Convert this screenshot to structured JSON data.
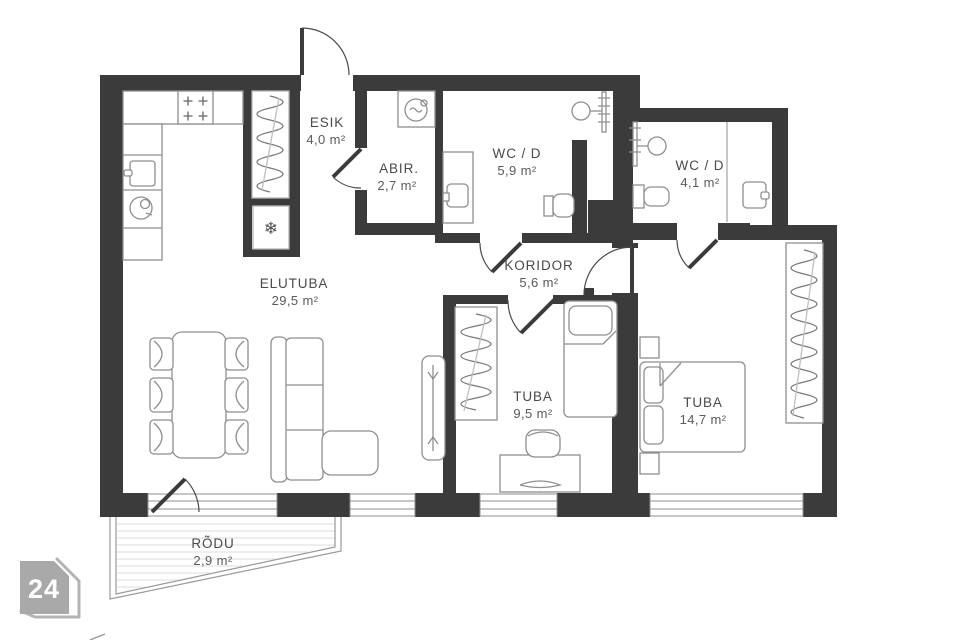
{
  "unit_badge": {
    "number": "24"
  },
  "rooms": [
    {
      "name": "ESIK",
      "area": "4,0 m²"
    },
    {
      "name": "ABIR.",
      "area": "2,7 m²"
    },
    {
      "name": "WC / D",
      "area": "5,9 m²"
    },
    {
      "name": "WC / D",
      "area": "4,1 m²"
    },
    {
      "name": "KORIDOR",
      "area": "5,6 m²"
    },
    {
      "name": "ELUTUBA",
      "area": "29,5 m²"
    },
    {
      "name": "TUBA",
      "area": "9,5 m²"
    },
    {
      "name": "TUBA",
      "area": "14,7 m²"
    },
    {
      "name": "RÕDU",
      "area": "2,9 m²"
    }
  ],
  "icons": {
    "fridge_snowflake": "❄"
  },
  "colors": {
    "wall": "#3b3b3b",
    "furniture_line": "#8f8f8f",
    "label": "#4a4a4a",
    "badge_bg": "#a9a9a9",
    "badge_text": "#ffffff"
  }
}
